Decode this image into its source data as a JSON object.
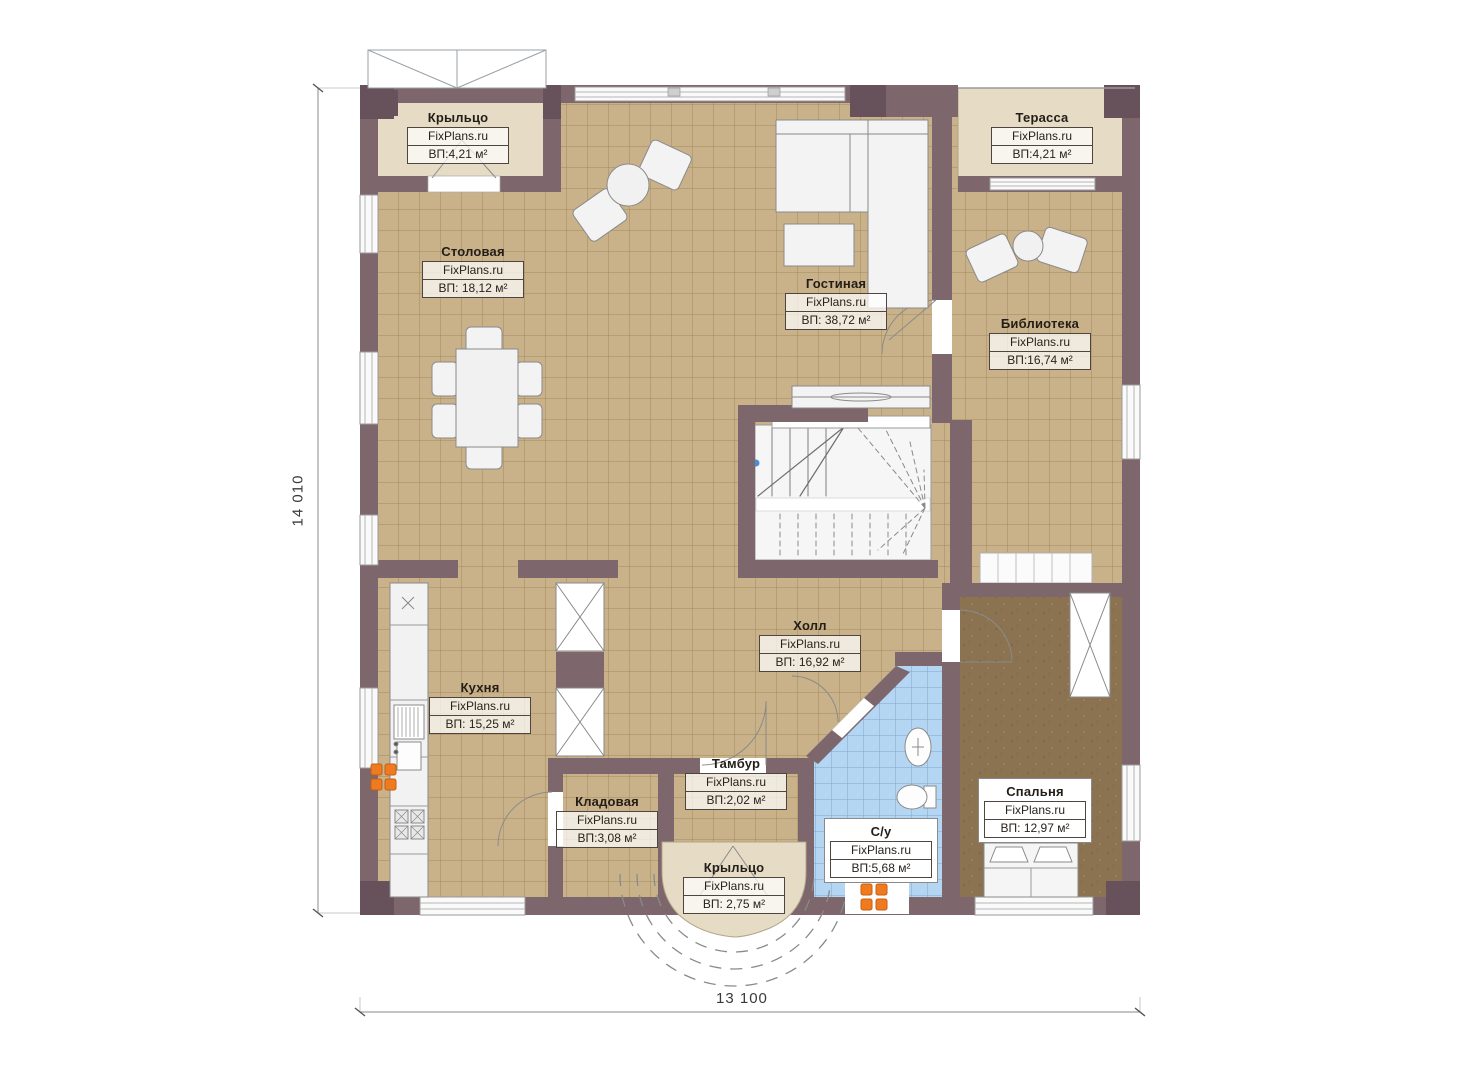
{
  "brand": "FixPlans.ru",
  "rooms": [
    {
      "id": "kryltso-top",
      "name": "Крыльцо",
      "area": "ВП:4,21 м²"
    },
    {
      "id": "terassa",
      "name": "Терасса",
      "area": "ВП:4,21 м²"
    },
    {
      "id": "stolovaya",
      "name": "Столовая",
      "area": "ВП: 18,12 м²"
    },
    {
      "id": "gostinaya",
      "name": "Гостиная",
      "area": "ВП: 38,72 м²"
    },
    {
      "id": "biblioteka",
      "name": "Библиотека",
      "area": "ВП:16,74 м²"
    },
    {
      "id": "kuhnya",
      "name": "Кухня",
      "area": "ВП: 15,25 м²"
    },
    {
      "id": "holl",
      "name": "Холл",
      "area": "ВП: 16,92 м²"
    },
    {
      "id": "tambur",
      "name": "Тамбур",
      "area": "ВП:2,02 м²"
    },
    {
      "id": "kladovaya",
      "name": "Кладовая",
      "area": "ВП:3,08 м²"
    },
    {
      "id": "su",
      "name": "С/у",
      "area": "ВП:5,68 м²"
    },
    {
      "id": "spalnya",
      "name": "Спальня",
      "area": "ВП: 12,97 м²"
    },
    {
      "id": "kryltso-bottom",
      "name": "Крыльцо",
      "area": "ВП: 2,75 м²"
    }
  ],
  "dimensions": {
    "height_label": "14 010",
    "width_label": "13 100"
  },
  "colors": {
    "wall": "#7d666c",
    "wall_dark": "#67515a",
    "tile_floor": "#c9b28a",
    "tile_line": "#a3895e",
    "porch": "#e6dcc6",
    "bathroom_tile": "#b5d6f2",
    "bedroom_floor": "#8b7352",
    "radiator": "#ef7b20",
    "furniture": "#f3f3f3",
    "dimension_line": "#8a8a8a"
  }
}
